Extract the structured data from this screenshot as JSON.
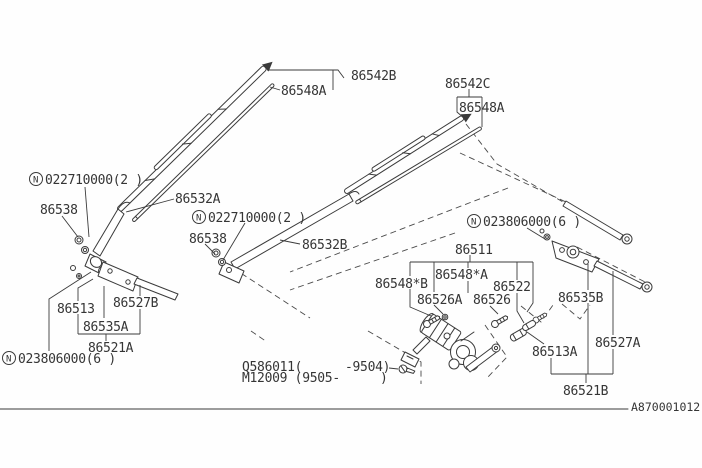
{
  "figure": {
    "id": "A870001012"
  },
  "labels": {
    "nut_022710000_a": {
      "prefix": "N",
      "code": "022710000(2 )"
    },
    "nut_022710000_b": {
      "prefix": "N",
      "code": "022710000(2 )"
    },
    "nut_023806000_a": {
      "prefix": "N",
      "code": "023806000(6 )"
    },
    "nut_023806000_b": {
      "prefix": "N",
      "code": "023806000(6 )"
    },
    "blade_assy_b": "86542B",
    "blade_assy_c": "86542C",
    "refill_a1": "86548A",
    "refill_a2": "86548A",
    "refill_star_a": "86548*A",
    "refill_star_b": "86548*B",
    "arm_86532a": "86532A",
    "arm_86532b": "86532B",
    "nut_86538_a": "86538",
    "nut_86538_b": "86538",
    "pivot_86513": "86513",
    "rod_86527b": "86527B",
    "cap_86535a": "86535A",
    "pivot_86521a": "86521A",
    "motor_86511": "86511",
    "bolt_86522": "86522",
    "grommet_86526a": "86526A",
    "grommet_86526": "86526",
    "cap_86535b": "86535B",
    "joint_86513a": "86513A",
    "rod_86527a": "86527A",
    "pivot_86521b": "86521B",
    "motor_code_q_left": "Q586011(",
    "motor_code_q_right": "-9504)",
    "motor_code_m_left": "M12009 (9505-",
    "motor_code_m_right": ")"
  },
  "colors": {
    "line": "#3b3b3b",
    "background": "#fefefe"
  }
}
